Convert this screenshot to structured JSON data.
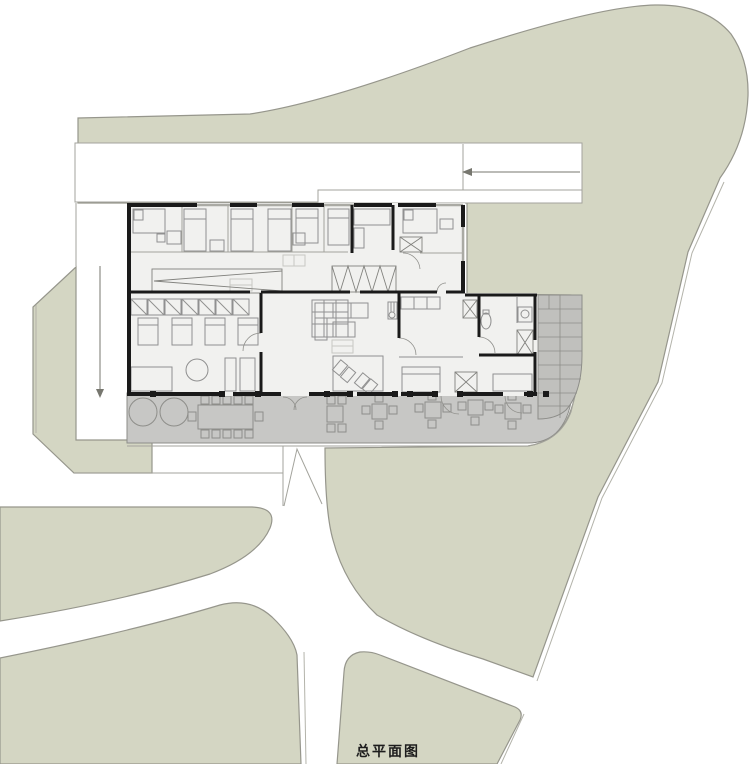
{
  "title": {
    "label": "总平面图"
  },
  "icons": {
    "road_arrow": "left-arrow",
    "site_entry_arrow": "down-arrow"
  },
  "colors": {
    "site-green": "#d4d6c3",
    "terrain-edge": "#96968c",
    "terrain-edge2": "#b3b3aa",
    "terrace-gray": "#c7c7c5",
    "tile-gray": "#c0c0bd",
    "room-fill": "#f1f1ef",
    "wall": "#1a1a1a",
    "furniture": "#909090",
    "line": "#a3a39c",
    "text": "#1d1d1d"
  }
}
